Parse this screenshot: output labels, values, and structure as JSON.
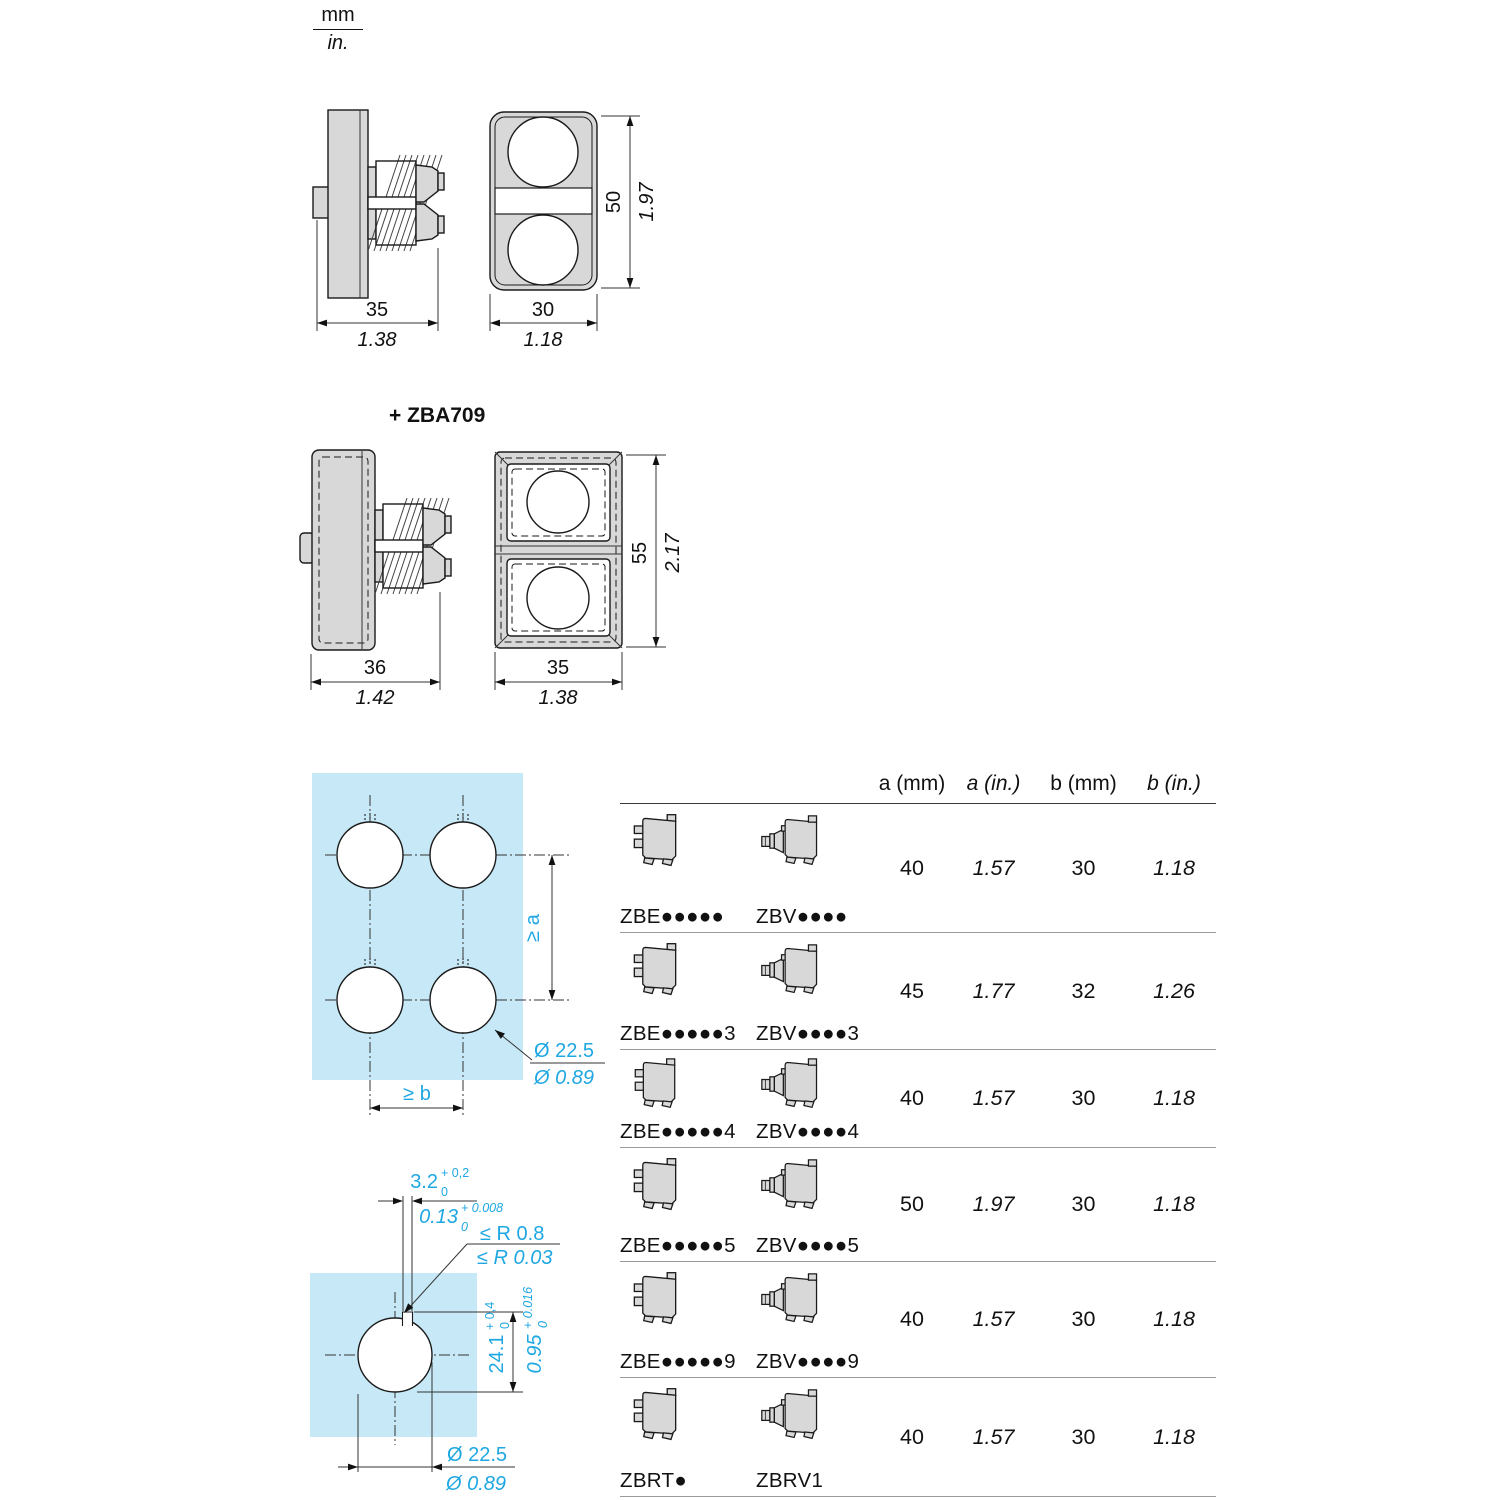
{
  "units": {
    "metric": "mm",
    "imperial": "in."
  },
  "drawing_top": {
    "side_width_mm": "35",
    "side_width_in": "1.38",
    "front_width_mm": "30",
    "front_width_in": "1.18",
    "front_height_mm": "50",
    "front_height_in": "1.97"
  },
  "drawing_zba709": {
    "title": "+ ZBA709",
    "side_width_mm": "36",
    "side_width_in": "1.42",
    "front_width_mm": "35",
    "front_width_in": "1.38",
    "front_height_mm": "55",
    "front_height_in": "2.17"
  },
  "cutout_multi": {
    "pitch_vertical": "≥ a",
    "pitch_horizontal": "≥ b",
    "hole_dia_mm": "Ø 22.5",
    "hole_dia_in": "Ø 0.89"
  },
  "cutout_single": {
    "slot_width_mm": "3.2",
    "slot_width_mm_tol_plus": "+ 0,2",
    "slot_width_mm_tol_minus": "0",
    "slot_width_in": "0.13",
    "slot_width_in_tol_plus": "+ 0.008",
    "slot_width_in_tol_minus": "0",
    "radius_mm": "≤ R 0.8",
    "radius_in": "≤ R 0.03",
    "recess_mm": "24.1",
    "recess_mm_tol_plus": "+ 0,4",
    "recess_mm_tol_minus": "0",
    "recess_in": "0.95",
    "recess_in_tol_plus": "+ 0.016",
    "recess_in_tol_minus": "0",
    "hole_dia_mm": "Ø 22.5",
    "hole_dia_in": "Ø 0.89"
  },
  "table": {
    "headers": {
      "a_mm": "a (mm)",
      "a_in": "a (in.)",
      "b_mm": "b (mm)",
      "b_in": "b (in.)"
    },
    "rows": [
      {
        "ref_left": "ZBE●●●●●",
        "ref_right": "ZBV●●●●",
        "a_mm": "40",
        "a_in": "1.57",
        "b_mm": "30",
        "b_in": "1.18"
      },
      {
        "ref_left": "ZBE●●●●●3",
        "ref_right": "ZBV●●●●3",
        "a_mm": "45",
        "a_in": "1.77",
        "b_mm": "32",
        "b_in": "1.26"
      },
      {
        "ref_left": "ZBE●●●●●4",
        "ref_right": "ZBV●●●●4",
        "a_mm": "40",
        "a_in": "1.57",
        "b_mm": "30",
        "b_in": "1.18"
      },
      {
        "ref_left": "ZBE●●●●●5",
        "ref_right": "ZBV●●●●5",
        "a_mm": "50",
        "a_in": "1.97",
        "b_mm": "30",
        "b_in": "1.18"
      },
      {
        "ref_left": "ZBE●●●●●9",
        "ref_right": "ZBV●●●●9",
        "a_mm": "40",
        "a_in": "1.57",
        "b_mm": "30",
        "b_in": "1.18"
      },
      {
        "ref_left": "ZBRT●",
        "ref_right": "ZBRV1",
        "a_mm": "40",
        "a_in": "1.57",
        "b_mm": "30",
        "b_in": "1.18"
      }
    ]
  },
  "colors": {
    "panel_cyan": "#c7e9f7",
    "accent_cyan": "#1ea7e2",
    "part_gray": "#d8d8d8"
  }
}
